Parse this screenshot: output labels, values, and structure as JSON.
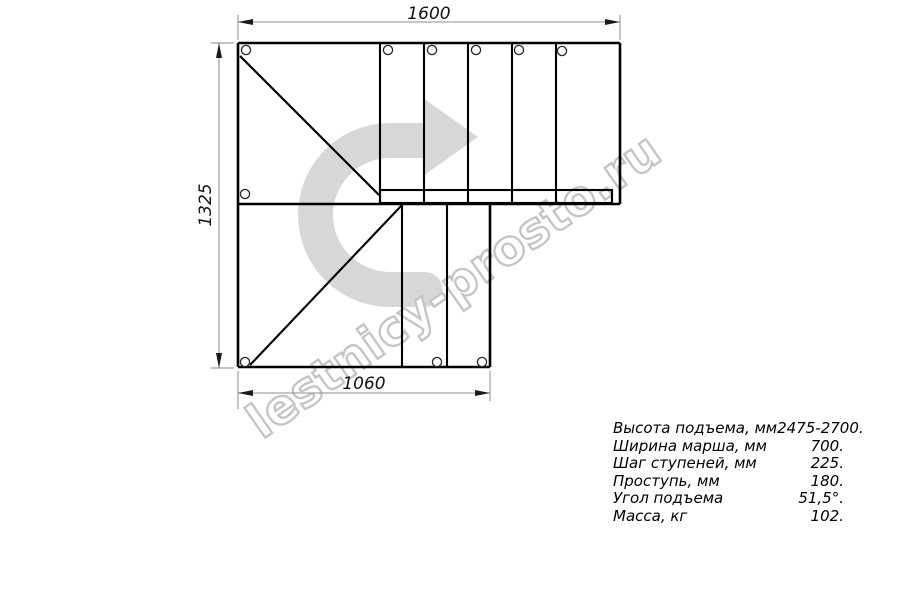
{
  "drawing": {
    "title": "staircase-plan-top-view",
    "dimensions": {
      "top": "1600",
      "left": "1325",
      "bottom": "1060"
    }
  },
  "watermark": {
    "text": "lestnicy-prosto.ru"
  },
  "specs": {
    "rows": [
      {
        "label": "Высота подъема, мм",
        "value": "2475-2700."
      },
      {
        "label": "Ширина марша, мм",
        "value": "700."
      },
      {
        "label": "Шаг ступеней, мм",
        "value": "225."
      },
      {
        "label": "Проступь, мм",
        "value": "180."
      },
      {
        "label": "Угол подъема",
        "value": "51,5°."
      },
      {
        "label": "Масса, кг",
        "value": "102."
      }
    ]
  },
  "colors": {
    "line": "#000000",
    "dimension_line": "#8c8c8c",
    "arrow_fill": "#d7d7d7",
    "watermark_outline": "#c4c4c4",
    "watermark_fill": "#ffffff"
  }
}
